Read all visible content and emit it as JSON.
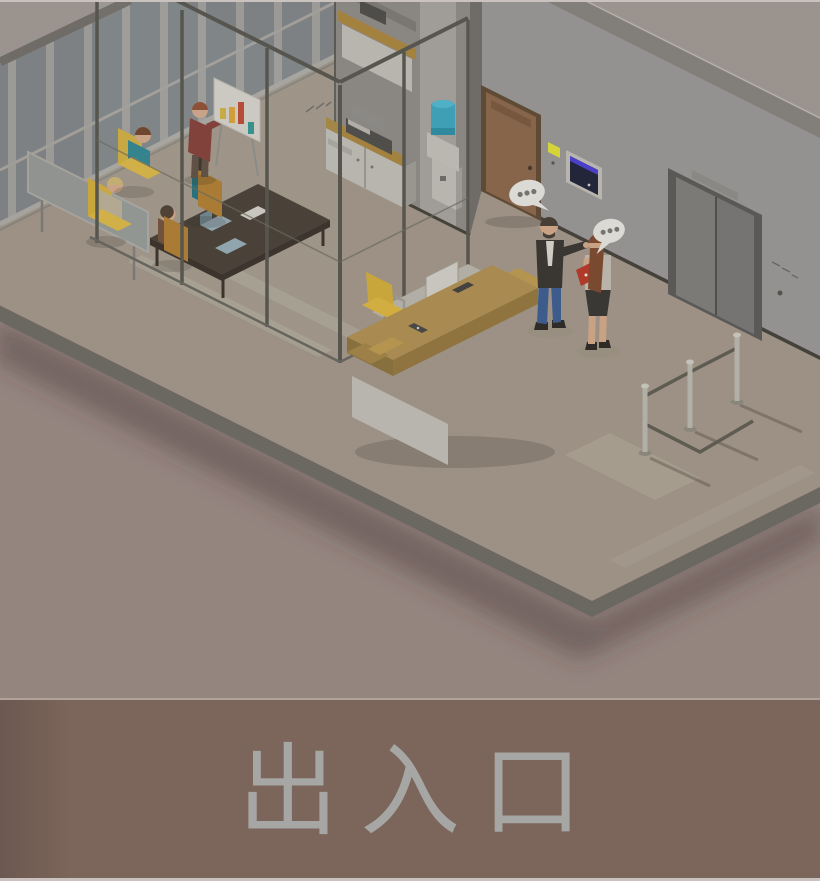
{
  "caption": {
    "text": "出入口"
  },
  "scene": {
    "name": "isometric-office-entrance-illustration",
    "speech_bubbles": {
      "count": 2,
      "dots_per_bubble": 3
    },
    "objects": [
      "window-wall",
      "presentation-screen",
      "meeting-room",
      "conference-table",
      "office-chairs",
      "presenter",
      "flip-chart",
      "glass-partition",
      "printer-cabinet",
      "top-cabinet",
      "water-cooler",
      "office-door",
      "door-sign",
      "wall-tablet",
      "reception-desk",
      "desk-monitor",
      "desk-chair",
      "visitor-man",
      "visitor-woman",
      "elevator",
      "elevator-call-button",
      "queue-barriers",
      "floor",
      "walkway-strips"
    ]
  },
  "colors": {
    "bg_top": "#9b948e",
    "bg_bottom": "#95857f",
    "floor_top": "#9c9184",
    "floor_edge": "#6b6861",
    "walkway": "#a8a092",
    "window_glass": "#7d8184",
    "window_mullion": "#9c9a96",
    "wall_face_l": "#8a8783",
    "wall_face_r": "#949290",
    "wall_strip": "#827e79",
    "wall_side_dark": "#6f6c68",
    "alcove": "#a09d98",
    "wood": "#a98a50",
    "wood_dark": "#8f7440",
    "wood_mid": "#9c8047",
    "cabinet_wood": "#a3823f",
    "white_furn": "#b8b5af",
    "table_dark": "#443a30",
    "chair_yellow": "#c8a63c",
    "chair_yellow_light": "#d2ae41",
    "chair_orange": "#a8762c",
    "door_face": "#87654a",
    "door_frame": "#5e4a35",
    "elevator_frame": "#5a5957",
    "elevator_door": "#7b7a77",
    "water_blue": "#3f9fb5",
    "water_blue_light": "#4fb0c6",
    "screen_dark": "#232638",
    "screen_accent": "#4a3fc9",
    "sign_yellow": "#d4d43a",
    "bubble": "#dcdad5",
    "bubble_dot": "#77746f",
    "skin": "#c9a183",
    "jeans": "#3d5c8c",
    "vest": "#3a3733",
    "shirt_white": "#cfccc4",
    "woman_top": "#b9b3a9",
    "skirt": "#3a3835",
    "hair_brown": "#7a4a30",
    "folder_red": "#b03a2a",
    "teal_person": "#2e7f8a",
    "teal_person_dark": "#206c78",
    "beige_person": "#b3a68e",
    "maroon": "#7e3a33",
    "bar_yellow": "#c9a93f",
    "bar_orange": "#d19b33",
    "bar_red": "#b5452f",
    "bar_teal": "#2f8f8a",
    "stanchion": "#b2afa6",
    "belt": "#5f5b52",
    "monitor": "#c7c5bd",
    "band": "#7c655a",
    "band_edge": "#b0a298",
    "caption_color": "#a6a6a4",
    "page_edge": "#c9c2be"
  }
}
